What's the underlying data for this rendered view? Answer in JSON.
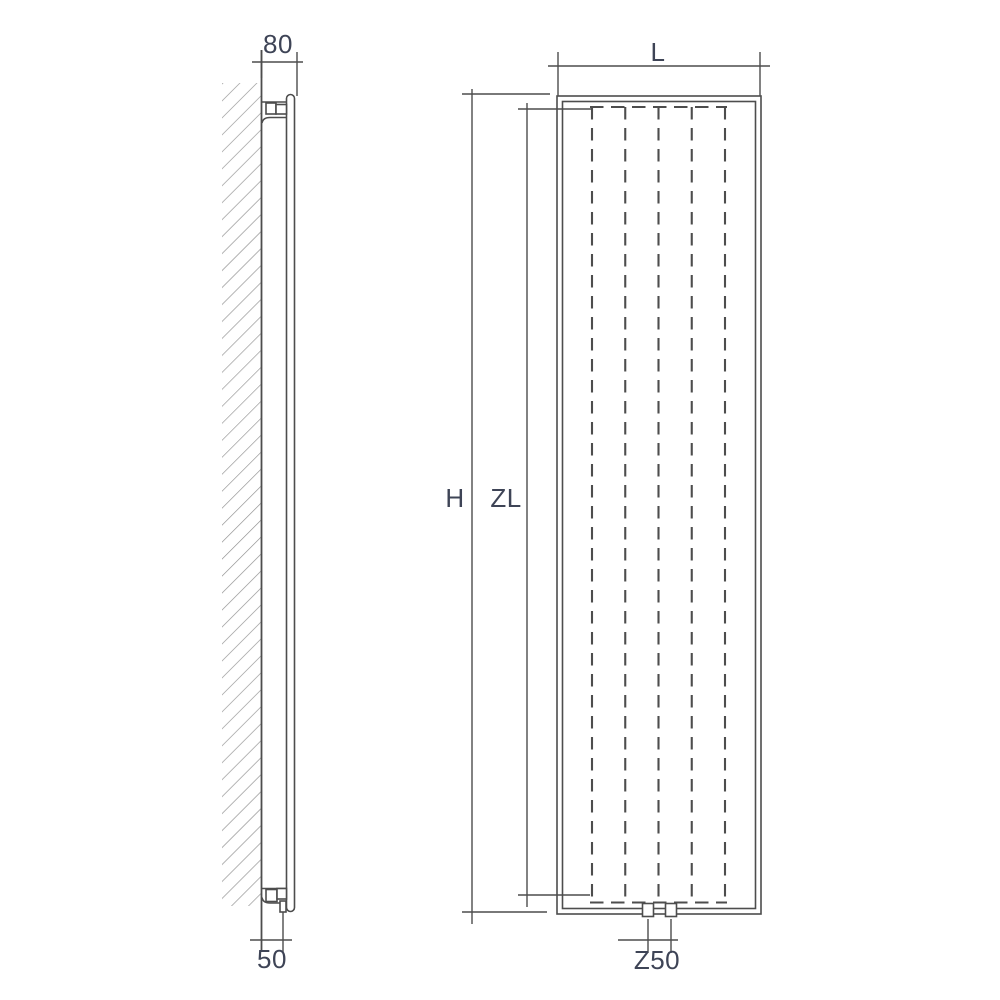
{
  "drawing": {
    "side_view": {
      "depth_dimension_label": "80",
      "pipe_wall_offset_label": "50"
    },
    "front_view": {
      "width_dimension_label": "L",
      "height_dimension_label": "H",
      "inner_length_dimension_label": "ZL",
      "pipe_spacing_dimension_label": "Z50"
    },
    "colors": {
      "line": "#4d4d4d",
      "hatch": "#8f8f8f",
      "label_text": "#3e4456",
      "background": "#ffffff"
    }
  }
}
